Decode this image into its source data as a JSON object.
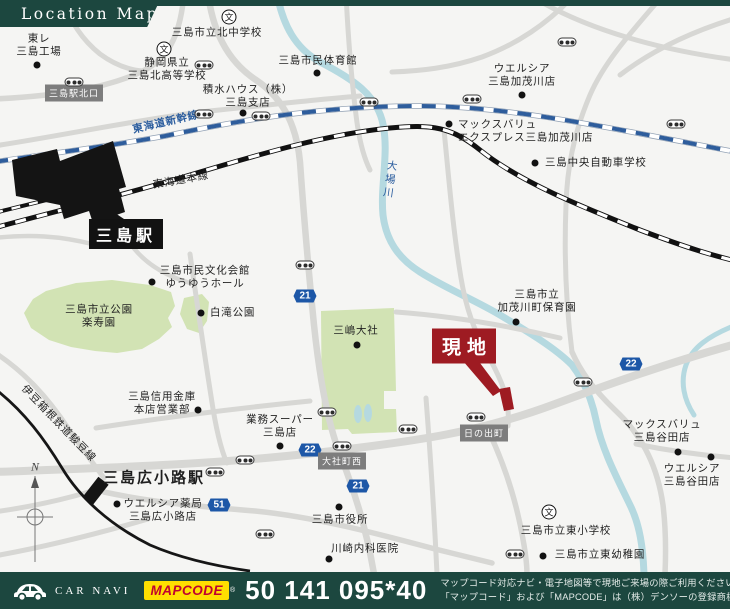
{
  "header": {
    "title": "Location Map"
  },
  "colors": {
    "green": "#1c473f",
    "red": "#9e1b22",
    "mapbg": "#f5f5f3",
    "road": "#d7d7d4",
    "park": "#d2e3b4",
    "water": "#b5d9e0",
    "watertext": "#2b5d9e",
    "railblue": "#2e5d9c",
    "shield": "#1d57a7",
    "badge": "#7d7d7d",
    "ink": "#1f1f1f",
    "yellow": "#ffdf00",
    "mapcodered": "#c0022f"
  },
  "map": {
    "site_label": "現地",
    "school_glyph": "文",
    "overlays": [
      {
        "t": "label",
        "name": "toray-mishima-plant",
        "text": "東レ\n三島工場",
        "x": 39,
        "y": 46
      },
      {
        "t": "dot",
        "x": 37,
        "y": 65
      },
      {
        "t": "school",
        "x": 229,
        "y": 17
      },
      {
        "t": "label",
        "name": "kita-junior-high",
        "text": "三島市立北中学校",
        "x": 217,
        "y": 33
      },
      {
        "t": "school",
        "x": 164,
        "y": 49
      },
      {
        "t": "label",
        "name": "kita-high-school",
        "text": "静岡県立\n三島北高等学校",
        "x": 167,
        "y": 70
      },
      {
        "t": "label",
        "name": "civic-gym",
        "text": "三島市民体育館",
        "x": 318,
        "y": 61
      },
      {
        "t": "dot",
        "x": 317,
        "y": 73
      },
      {
        "t": "label",
        "name": "sekisui-house",
        "text": "積水ハウス（株）\n三島支店",
        "x": 248,
        "y": 97
      },
      {
        "t": "dot",
        "x": 243,
        "y": 113
      },
      {
        "t": "label",
        "name": "welcia-kamogawa",
        "text": "ウエルシア\n三島加茂川店",
        "x": 522,
        "y": 76
      },
      {
        "t": "dot",
        "x": 522,
        "y": 95
      },
      {
        "t": "dot",
        "x": 449,
        "y": 124
      },
      {
        "t": "label",
        "name": "maxvalu-express",
        "text": "マックスバリュ\nエクスプレス三島加茂川店",
        "x": 458,
        "y": 132,
        "anchor": "left"
      },
      {
        "t": "dot",
        "x": 535,
        "y": 163
      },
      {
        "t": "label",
        "name": "driving-school",
        "text": "三島中央自動車学校",
        "x": 545,
        "y": 163,
        "anchor": "left"
      },
      {
        "t": "badge",
        "name": "station-north-exit-badge",
        "text": "三島駅北口",
        "x": 74,
        "y": 93
      },
      {
        "t": "label",
        "name": "shinkansen-label",
        "text": "東海道新幹線",
        "x": 166,
        "y": 123,
        "rot": -13,
        "cls": "water bold"
      },
      {
        "t": "label",
        "name": "tokaido-main-line-label",
        "text": "東海道本線",
        "x": 181,
        "y": 181,
        "rot": -10
      },
      {
        "t": "stationbox",
        "name": "mishima-station-label",
        "text": "三島駅",
        "x": 126,
        "y": 234
      },
      {
        "t": "label",
        "name": "culture-hall",
        "text": "三島市民文化会館\nゆうゆうホール",
        "x": 205,
        "y": 278
      },
      {
        "t": "dot",
        "x": 152,
        "y": 282
      },
      {
        "t": "label",
        "name": "rakujuen-park",
        "text": "三島市立公園\n楽寿園",
        "x": 99,
        "y": 317
      },
      {
        "t": "dot",
        "x": 201,
        "y": 313
      },
      {
        "t": "label",
        "name": "shirataki-park",
        "text": "白滝公園",
        "x": 210,
        "y": 313,
        "anchor": "left"
      },
      {
        "t": "label",
        "name": "obagawa-river-label",
        "text": "大場川",
        "x": 389,
        "y": 180,
        "rot": 8,
        "cls": "water vert"
      },
      {
        "t": "label",
        "name": "shinkin-bank",
        "text": "三島信用金庫\n本店営業部",
        "x": 162,
        "y": 404
      },
      {
        "t": "dot",
        "x": 198,
        "y": 410
      },
      {
        "t": "label",
        "name": "mishima-taisha",
        "text": "三嶋大社",
        "x": 356,
        "y": 331
      },
      {
        "t": "dot",
        "x": 357,
        "y": 345
      },
      {
        "t": "label",
        "name": "kamogawa-nursery",
        "text": "三島市立\n加茂川町保育園",
        "x": 537,
        "y": 302
      },
      {
        "t": "dot",
        "x": 516,
        "y": 322
      },
      {
        "t": "genchi",
        "name": "site-callout",
        "x": 464,
        "y": 346
      },
      {
        "t": "shield",
        "x": 305,
        "y": 296,
        "text": "21"
      },
      {
        "t": "shield",
        "x": 631,
        "y": 364,
        "text": "22"
      },
      {
        "t": "shield",
        "x": 310,
        "y": 450,
        "text": "22"
      },
      {
        "t": "shield",
        "x": 358,
        "y": 486,
        "text": "21"
      },
      {
        "t": "shield",
        "x": 219,
        "y": 505,
        "text": "51"
      },
      {
        "t": "badge",
        "name": "taishacho-nishi-badge",
        "text": "大社町西",
        "x": 342,
        "y": 461
      },
      {
        "t": "badge",
        "name": "hinodecho-badge",
        "text": "日の出町",
        "x": 484,
        "y": 433
      },
      {
        "t": "label",
        "name": "gyomu-super",
        "text": "業務スーパー\n三島店",
        "x": 280,
        "y": 427
      },
      {
        "t": "dot",
        "x": 280,
        "y": 446
      },
      {
        "t": "label",
        "name": "izuhakone-line-label",
        "text": "伊豆箱根鉄道駿豆線",
        "x": 58,
        "y": 424,
        "rot": 46
      },
      {
        "t": "label",
        "name": "hirokoji-station-label",
        "text": "三島広小路駅",
        "x": 154,
        "y": 479,
        "cls": "big"
      },
      {
        "t": "label",
        "name": "welcia-pharmacy-hirokoji",
        "text": "ウエルシア薬局\n三島広小路店",
        "x": 163,
        "y": 511
      },
      {
        "t": "dot",
        "x": 117,
        "y": 504
      },
      {
        "t": "label",
        "name": "compass-n",
        "text": "N",
        "x": 35,
        "y": 467,
        "cls": "compass"
      },
      {
        "t": "label",
        "name": "city-hall",
        "text": "三島市役所",
        "x": 340,
        "y": 520
      },
      {
        "t": "dot",
        "x": 339,
        "y": 507
      },
      {
        "t": "label",
        "name": "kawasaki-clinic",
        "text": "川崎内科医院",
        "x": 365,
        "y": 549
      },
      {
        "t": "dot",
        "x": 329,
        "y": 559
      },
      {
        "t": "label",
        "name": "maxvalu-yata",
        "text": "マックスバリュ\n三島谷田店",
        "x": 662,
        "y": 432
      },
      {
        "t": "dot",
        "x": 678,
        "y": 452
      },
      {
        "t": "dot",
        "x": 711,
        "y": 457
      },
      {
        "t": "label",
        "name": "welcia-yata",
        "text": "ウエルシア\n三島谷田店",
        "x": 692,
        "y": 476
      },
      {
        "t": "school",
        "x": 549,
        "y": 512
      },
      {
        "t": "label",
        "name": "higashi-elementary",
        "text": "三島市立東小学校",
        "x": 566,
        "y": 531
      },
      {
        "t": "dot",
        "x": 543,
        "y": 556
      },
      {
        "t": "label",
        "name": "higashi-kindergarten",
        "text": "三島市立東幼稚園",
        "x": 600,
        "y": 555
      }
    ],
    "signals": [
      [
        74,
        82
      ],
      [
        204,
        65
      ],
      [
        204,
        114
      ],
      [
        261,
        116
      ],
      [
        369,
        102
      ],
      [
        472,
        99
      ],
      [
        567,
        42
      ],
      [
        676,
        124
      ],
      [
        305,
        265
      ],
      [
        327,
        412
      ],
      [
        342,
        446
      ],
      [
        245,
        460
      ],
      [
        265,
        534
      ],
      [
        215,
        472
      ],
      [
        583,
        382
      ],
      [
        476,
        417
      ],
      [
        408,
        429
      ],
      [
        515,
        554
      ]
    ]
  },
  "footer": {
    "car_navi": "CAR NAVI",
    "mapcode_logo": "MAPCODE",
    "reg": "®",
    "code": "50 141 095*40",
    "note1": "マップコード対応ナビ・電子地図等で現地ご来場の際ご利用ください。",
    "note2": "「マップコード」および「MAPCODE」は（株）デンソーの登録商標です。"
  }
}
